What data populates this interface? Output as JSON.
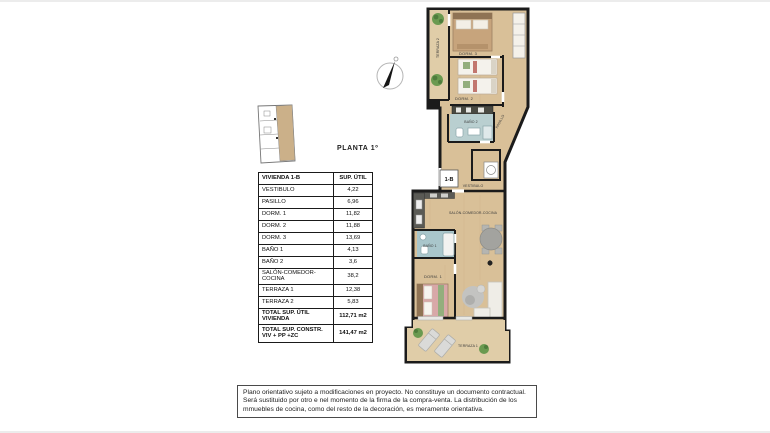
{
  "floor_title": "PLANTA 1º",
  "table": {
    "header": {
      "name": "VIVIENDA 1-B",
      "area": "SUP. ÚTIL"
    },
    "rows": [
      {
        "label": "VESTIBULO",
        "value": "4,22"
      },
      {
        "label": "PASILLO",
        "value": "6,96"
      },
      {
        "label": "DORM. 1",
        "value": "11,82"
      },
      {
        "label": "DORM. 2",
        "value": "11,88"
      },
      {
        "label": "DORM. 3",
        "value": "13,69"
      },
      {
        "label": "BAÑO 1",
        "value": "4,13"
      },
      {
        "label": "BAÑO 2",
        "value": "3,6"
      },
      {
        "label": "SALÓN-COMEDOR-COCINA",
        "value": "38,2"
      },
      {
        "label": "TERRAZA 1",
        "value": "12,38"
      },
      {
        "label": "TERRAZA 2",
        "value": "5,83"
      }
    ],
    "totals": [
      {
        "label": "TOTAL SUP. ÚTIL VIVIENDA",
        "value": "112,71 m2"
      },
      {
        "label": "TOTAL SUP. CONSTR. VIV + PP +ZC",
        "value": "141,47 m2"
      }
    ]
  },
  "plan": {
    "unit_tag": "1-B",
    "labels": {
      "terraza2": "TERRAZA 2",
      "dorm3": "DORM. 3",
      "dorm2": "DORM. 2",
      "bano2": "BAÑO 2",
      "pasillo": "PASILLO",
      "vestibulo": "VESTIBULO",
      "salon": "SALÓN-COMEDOR-COCINA",
      "bano1": "BAÑO 1",
      "dorm1": "DORM. 1",
      "terraza1": "TERRAZA 1"
    }
  },
  "disclaimer": {
    "text": "Plano orientativo sujeto a modificaciones en proyecto. No constituye un documento contractual. Será sustituido por otro e nel momento de la firma de la compra-venta. La distribución de los mmuebles de cocina, como del resto de la decoración, es meramente orientativa."
  },
  "colors": {
    "wood": "#d9c098",
    "terrace_wood": "#e0cda8",
    "wall": "#1b1b1b",
    "bath_tile": "#b9cfd0",
    "bath_tile_dark": "#a9c6cb",
    "highlight_tan": "#cbb089"
  }
}
